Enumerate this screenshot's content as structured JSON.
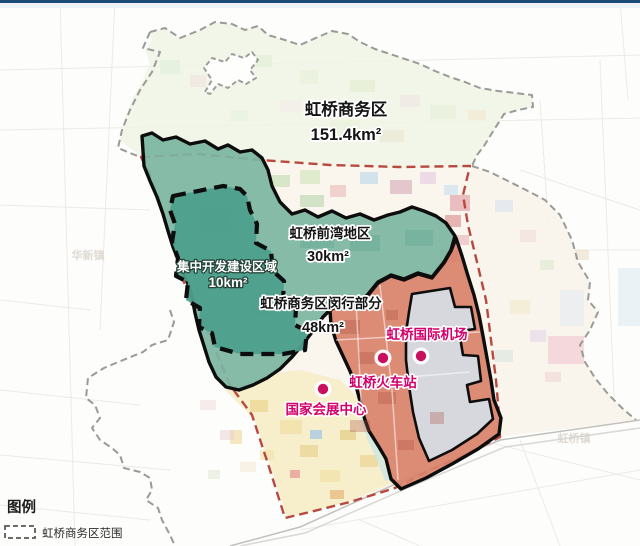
{
  "header": {
    "bar_color": "#1b4d78"
  },
  "map": {
    "regions": {
      "business_district": {
        "name": "虹桥商务区",
        "area": "151.4km²",
        "boundary_color": "#b8493f"
      },
      "qianwan": {
        "name": "虹桥前湾地区",
        "area": "30km²",
        "fill": "#7cb6a1"
      },
      "core_dev": {
        "name": "集中开发建设区域",
        "area": "10km²",
        "fill": "#4d9f8b"
      },
      "minhang": {
        "name": "虹桥商务区闵行部分",
        "area": "48km²",
        "fill": "#d9826c"
      }
    },
    "pois": [
      {
        "label": "虹桥国际机场",
        "marker_color": "#c9105f"
      },
      {
        "label": "虹桥火车站",
        "marker_color": "#c9105f"
      },
      {
        "label": "国家会展中心",
        "marker_color": "#c9105f"
      }
    ],
    "background_towns": [
      {
        "label": "华新镇"
      },
      {
        "label": "虹桥镇"
      }
    ]
  },
  "legend": {
    "title": "图例",
    "items": [
      {
        "label": "虹桥商务区范围",
        "swatch": "dashed-outline-box"
      }
    ]
  }
}
